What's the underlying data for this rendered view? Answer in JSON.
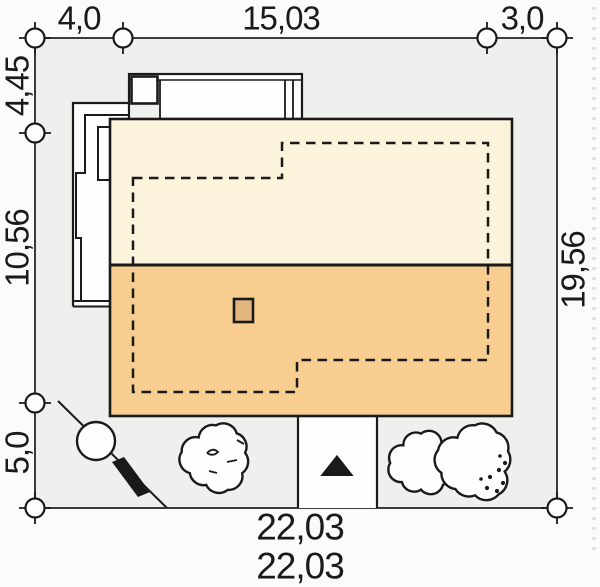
{
  "dims": {
    "top_left": "4,0",
    "top_mid": "15,03",
    "top_right": "3,0",
    "left_top": "4,45",
    "left_mid": "10,56",
    "left_bottom": "5,0",
    "right_side": "19,56",
    "bottom_total": "22,03",
    "bottom_clipped": "22,03"
  },
  "icons": {
    "north_arrow": "▲"
  },
  "colors": {
    "page_bg": "#fbfbfa",
    "plot_bg": "#efefed",
    "line": "#1a1a1a",
    "white": "#fefefe",
    "roof_upper": "#fcf3dc",
    "roof_lower": "#f8cd90",
    "chimney_fill": "#e2b77f"
  }
}
